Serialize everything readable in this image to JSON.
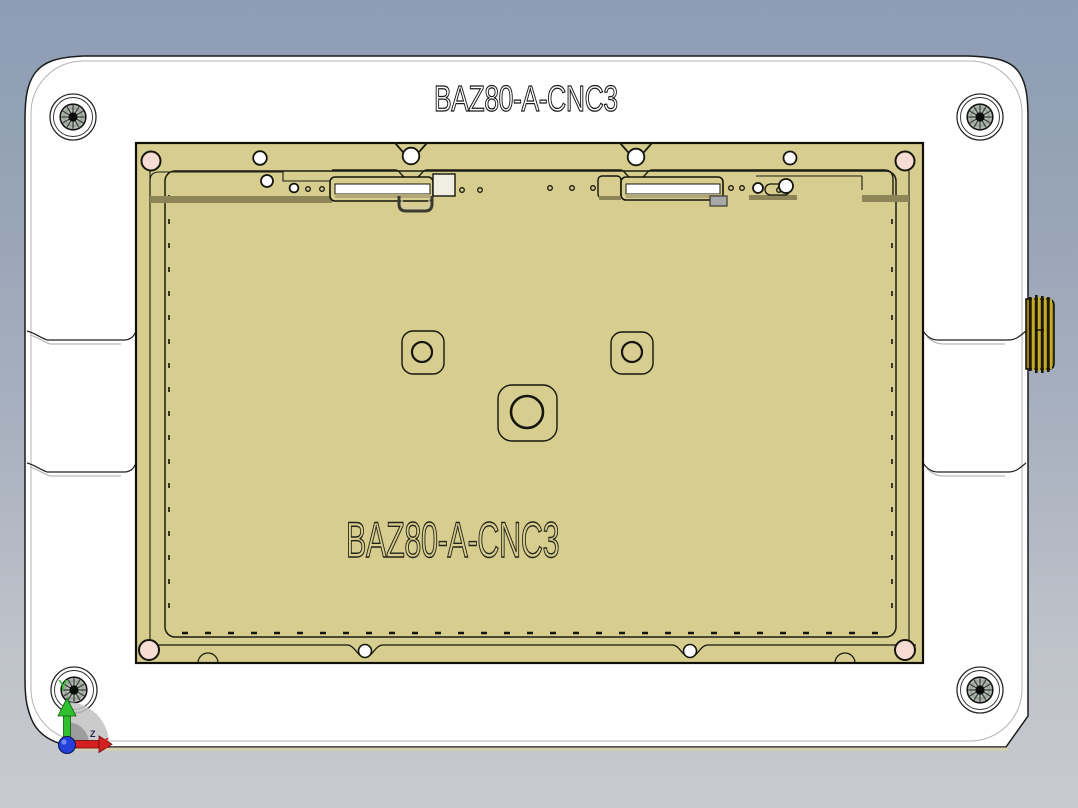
{
  "viewport": {
    "title_text": "BAZ80-A-CNC3",
    "engraving_text": "BAZ80-A-CNC3"
  },
  "triad": {
    "x_label": "X",
    "y_label": "Y",
    "z_label": "Z",
    "x_color": "#d42020",
    "y_color": "#2fbf2f",
    "z_color": "#26264a",
    "origin_color": "#2440d8"
  },
  "colors": {
    "background_top": "#8d9db4",
    "background_bottom": "#c7cacf",
    "plate": "#ffffff",
    "plate_edge_strip": "#d5cfab",
    "fixture": "#d6cd8e",
    "fixture_shadow": "#8d8557",
    "pin_pink": "#f7dcd4",
    "hole_white": "#ffffff",
    "screw_head": "#b7bfb7",
    "thumbscrew_gold": "#95831a",
    "thumbscrew_dark": "#1c1605",
    "thumbscrew_light": "#c3ad26"
  },
  "icons": {
    "corner_screws": "socket-head-screw-icon",
    "thumbscrew": "knurled-thumbscrew-icon",
    "triad": "origin-triad-icon"
  }
}
